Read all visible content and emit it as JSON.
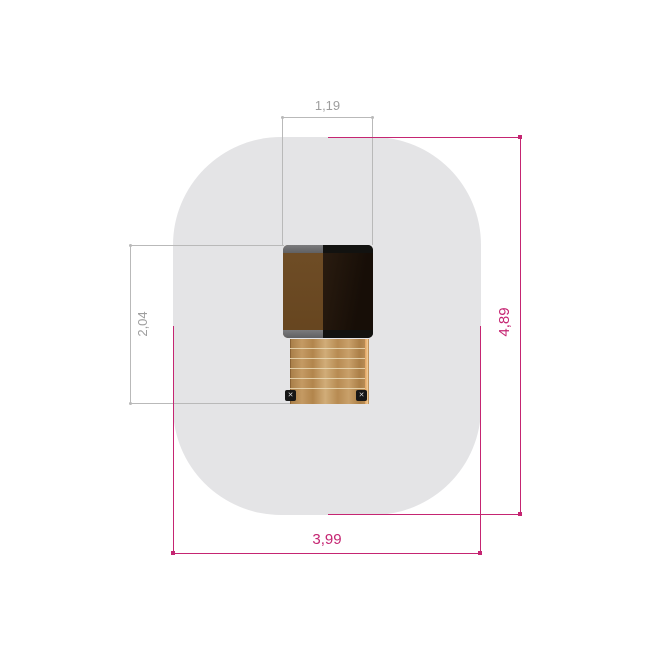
{
  "drawing": {
    "title": "playground equipment plan view",
    "dimensions": {
      "tower_width": {
        "label": "1,19"
      },
      "equipment_depth": {
        "label": "2,04"
      },
      "safety_zone_length": {
        "label": "4,89"
      },
      "safety_zone_width": {
        "label": "3,99"
      }
    },
    "bracket_mark": "✕"
  },
  "colors": {
    "background": "#ffffff",
    "safety_zone": "#e4e4e6",
    "dim_line_gray": "#b9b9b9",
    "dim_text_gray": "#9e9e9e",
    "dim_magenta": "#c52572",
    "roof_panel_brown": "#6b4a23",
    "roof_trim_gray": "#6d6d6f",
    "roof_panel_dark": "#1c1209",
    "roof_trim_dark": "#121210",
    "wood_base": "#bf955e",
    "wood_rung_line": "#ead9b4",
    "wood_edge_highlight": "#f3cf9b",
    "bracket_dark": "#161616",
    "bracket_mark": "#d8d8d8"
  }
}
